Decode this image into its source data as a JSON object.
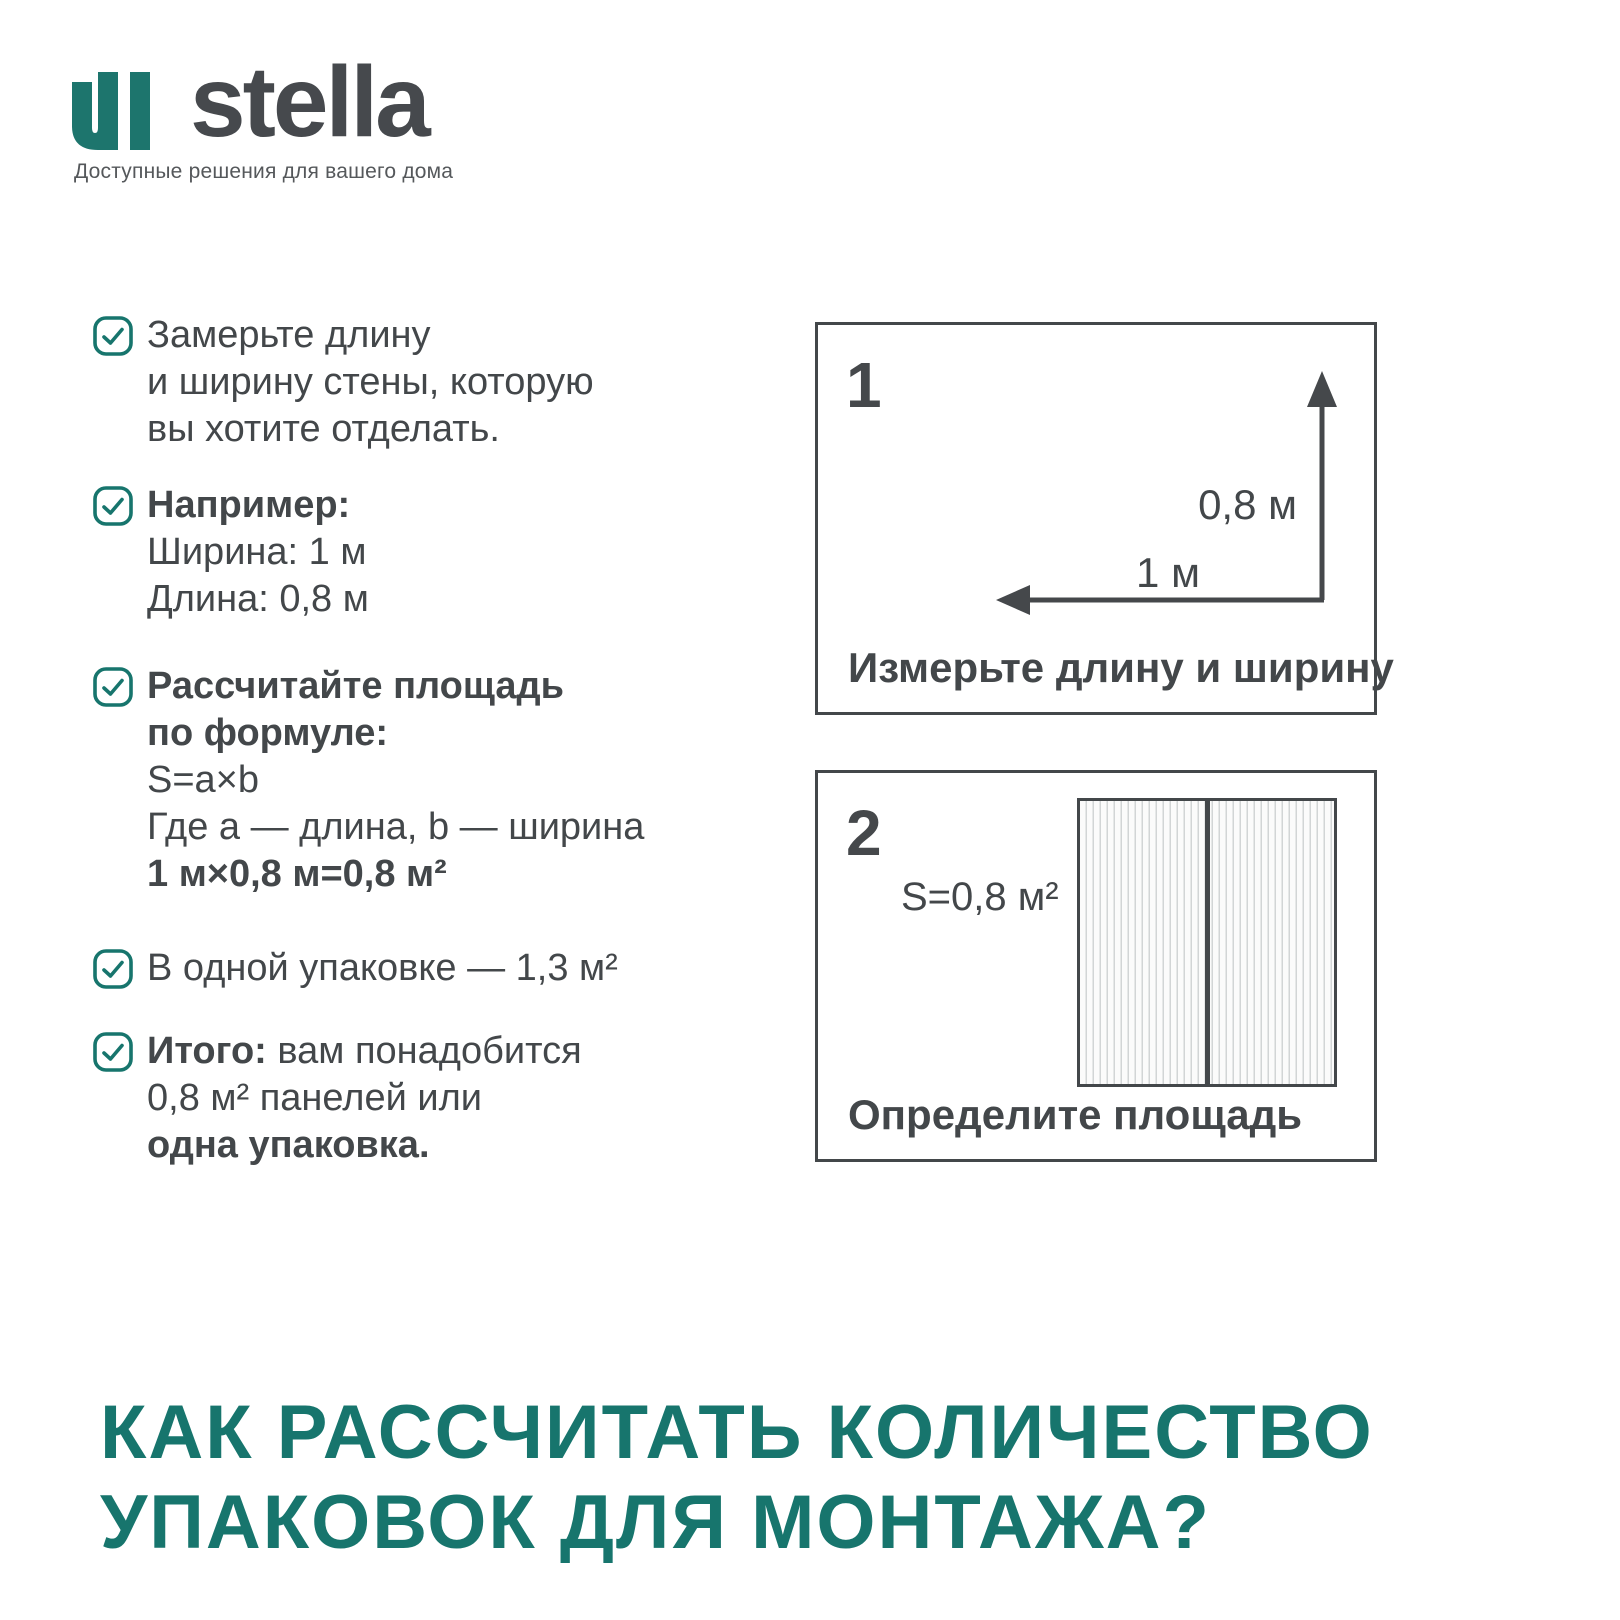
{
  "brand": {
    "wordmark": "stella",
    "tagline": "Доступные решения для вашего дома"
  },
  "checklist": [
    {
      "line1": "Замерьте длину",
      "line2": "и ширину стены, которую",
      "line3": "вы хотите отделать."
    },
    {
      "heading": "Например:",
      "line1": "Ширина: 1 м",
      "line2": "Длина: 0,8 м"
    },
    {
      "heading1": "Рассчитайте площадь",
      "heading2": "по формуле:",
      "line1": "S=a×b",
      "line2": "Где a — длина, b — ширина",
      "formula": "1 м×0,8 м=0,8 м²"
    },
    {
      "line1": "В одной упаковке — 1,3 м²"
    },
    {
      "lead": "Итого:",
      "line1": " вам понадобится",
      "line2": "0,8 м² панелей или",
      "line3": "одна упаковка."
    }
  ],
  "step1": {
    "number": "1",
    "vertical_label": "0,8 м",
    "horizontal_label": "1 м",
    "caption": "Измерьте длину и ширину"
  },
  "step2": {
    "number": "2",
    "area_label": "S=0,8 м²",
    "caption": "Определите площадь"
  },
  "headline": {
    "line1": "КАК РАССЧИТАТЬ КОЛИЧЕСТВО",
    "line2": "УПАКОВОК ДЛЯ МОНТАЖА?"
  },
  "colors": {
    "accent_teal": "#17756d",
    "text_dark": "#43474a"
  }
}
